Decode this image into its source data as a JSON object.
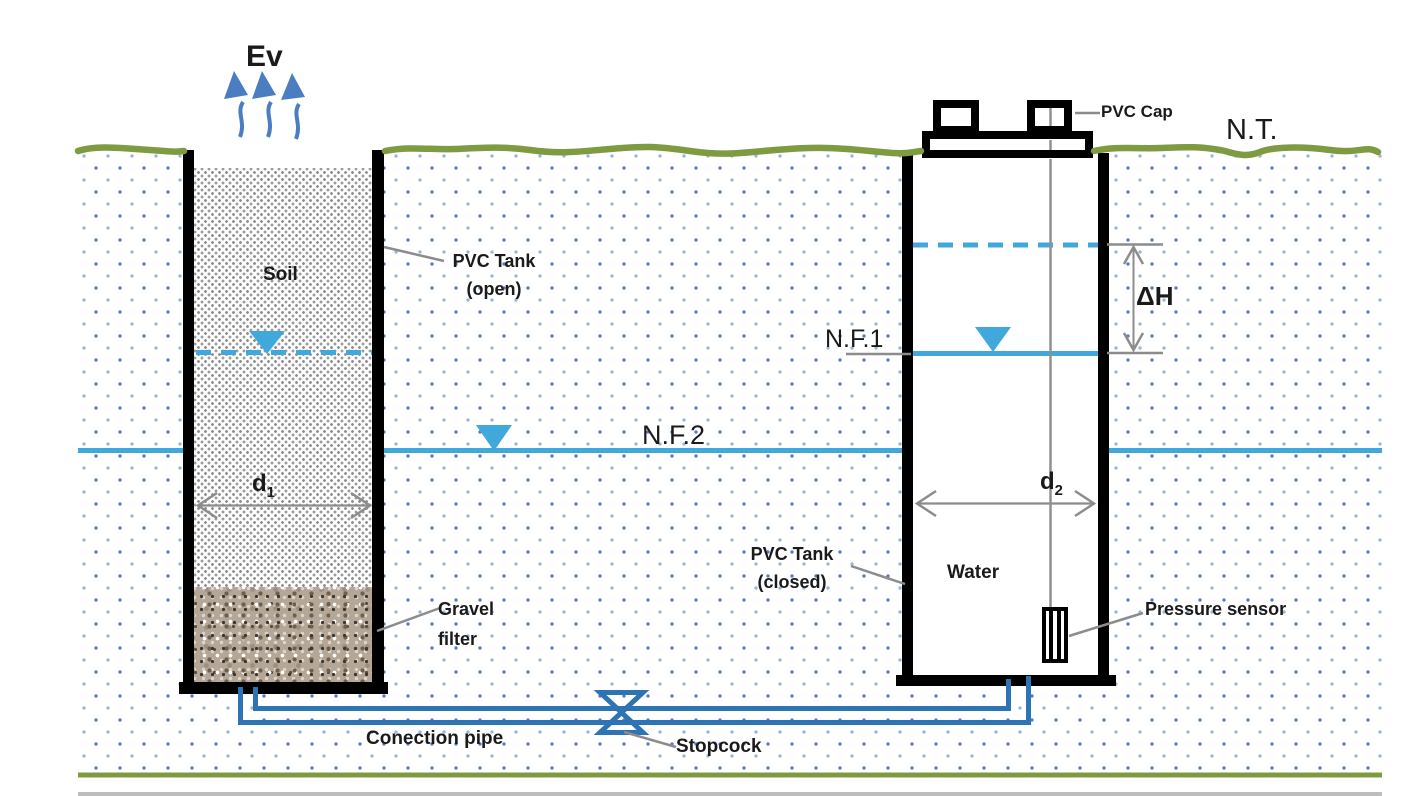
{
  "diagram": {
    "evaporation_label": "Ev",
    "terrain_label": "N.T.",
    "water_level_1_label": "N.F.1",
    "water_level_2_label": "N.F.2",
    "delta_h_label": "ΔH",
    "left_tank": {
      "soil_label": "Soil",
      "tank_label_line1": "PVC Tank",
      "tank_label_line2": "(open)",
      "gravel_label_line1": "Gravel",
      "gravel_label_line2": "filter",
      "diameter_label": "d",
      "diameter_sub": "1"
    },
    "right_tank": {
      "cap_label": "PVC Cap",
      "tank_label_line1": "PVC Tank",
      "tank_label_line2": "(closed)",
      "water_label": "Water",
      "sensor_label": "Pressure sensor",
      "diameter_label": "d",
      "diameter_sub": "2"
    },
    "pipe": {
      "pipe_label": "Conection pipe",
      "valve_label": "Stopcock"
    },
    "colors": {
      "water_blue": "#41a8dc",
      "pipe_blue": "#2e74b5",
      "arrow_blue": "#4a7ec0",
      "ground_green": "#7f9b42",
      "leader_gray": "#8c8c8c",
      "dot_blue": "#4976bc",
      "tank_black": "#000000"
    }
  }
}
